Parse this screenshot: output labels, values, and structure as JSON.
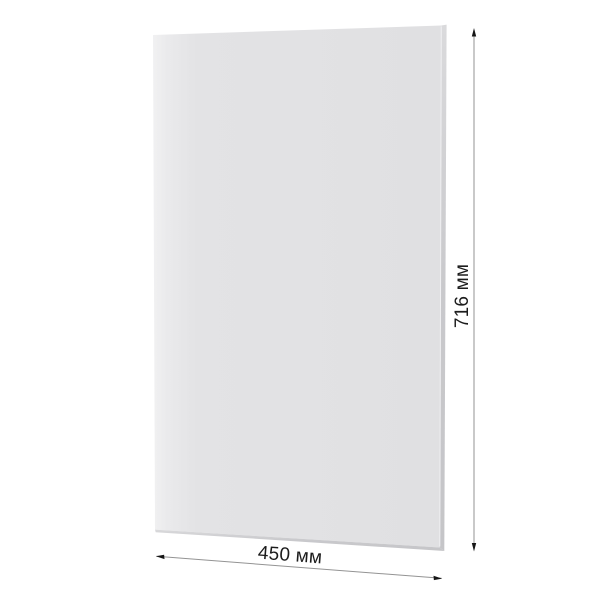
{
  "background_color": "#ffffff",
  "panel": {
    "face_highlight_color": "#f1f1f2",
    "face_color": "#e3e3e5",
    "face_color_right": "#e0e0e2",
    "edge_color_top": "#dadadc",
    "edge_color": "#c9c9cc",
    "edge_color_bottom": "#c5c5c8",
    "fold_highlight_color": "#f0f0f2"
  },
  "dimensions": {
    "height": {
      "label": "716 мм",
      "value_mm": 716
    },
    "width": {
      "label": "450 мм",
      "value_mm": 450
    },
    "line_color": "#939393",
    "arrow_color": "#161616",
    "label_color": "#1c1c1c"
  }
}
